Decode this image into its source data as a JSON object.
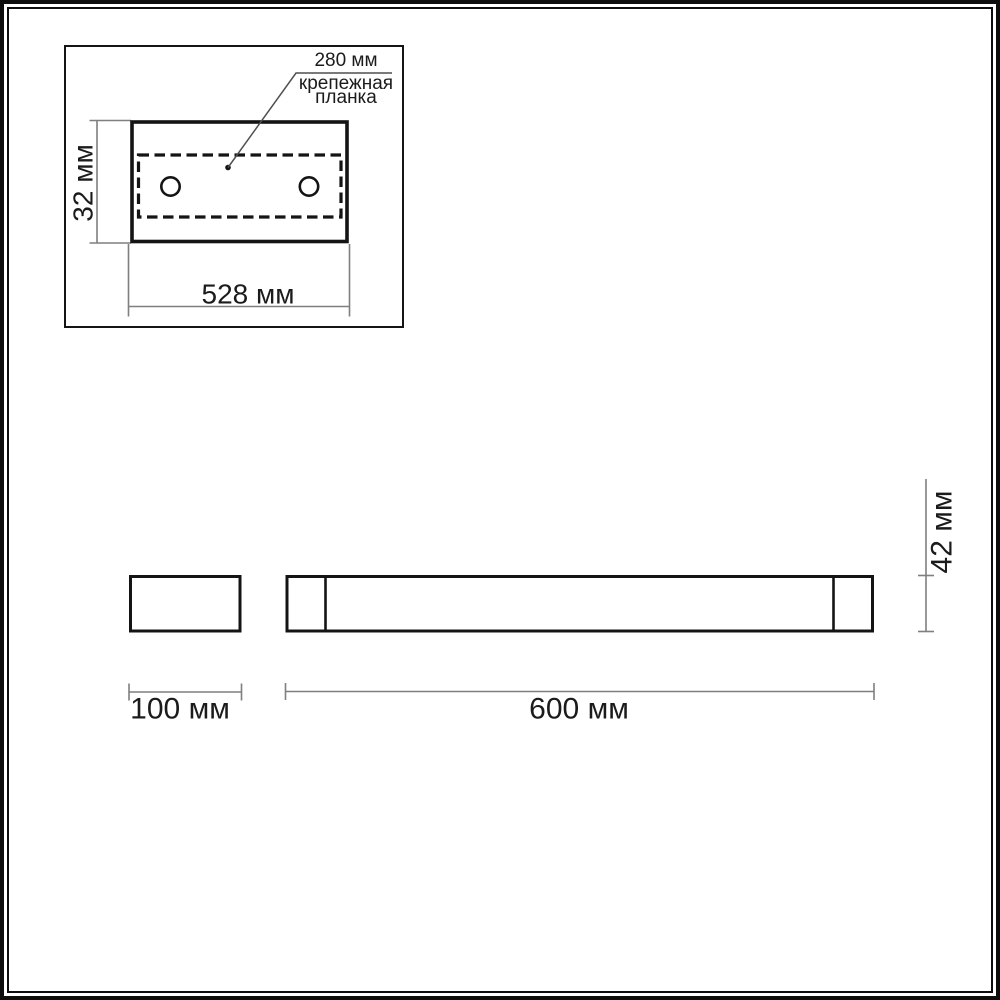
{
  "page": {
    "background": "#ffffff",
    "frame_color": "#0d0d0d"
  },
  "colors": {
    "shape_stroke": "#141414",
    "dimension_line": "#7f7f7f",
    "leader_line": "#4f4f4f",
    "text": "#1b1b1b"
  },
  "top_view": {
    "hole_pitch_label": "280 мм",
    "callout_line1": "крепежная",
    "callout_line2": "планка",
    "height_label": "32 мм",
    "width_label": "528 мм"
  },
  "side_view": {
    "depth_label": "100 мм"
  },
  "front_view": {
    "length_label": "600 мм",
    "height_label": "42 мм"
  }
}
